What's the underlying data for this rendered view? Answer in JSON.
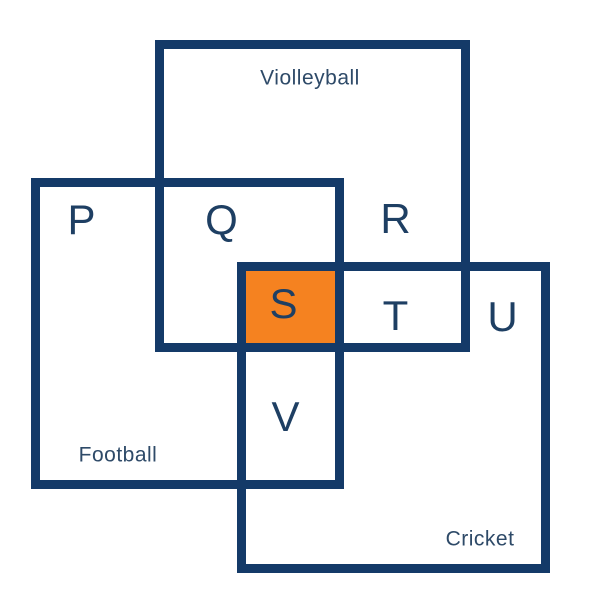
{
  "diagram": {
    "type": "overlapping-rectangles-venn",
    "sets": [
      {
        "label": "Violleyball"
      },
      {
        "label": "Football"
      },
      {
        "label": "Cricket"
      }
    ],
    "regions": [
      {
        "label": "P",
        "meaning": "Football only",
        "highlighted": false
      },
      {
        "label": "Q",
        "meaning": "Violleyball and Football",
        "highlighted": false
      },
      {
        "label": "R",
        "meaning": "Violleyball only",
        "highlighted": false
      },
      {
        "label": "S",
        "meaning": "Violleyball, Football and Cricket",
        "highlighted": true
      },
      {
        "label": "T",
        "meaning": "Violleyball and Cricket",
        "highlighted": false
      },
      {
        "label": "U",
        "meaning": "Cricket only",
        "highlighted": false
      },
      {
        "label": "V",
        "meaning": "Football and Cricket",
        "highlighted": false
      }
    ],
    "colors": {
      "border": "#143A68",
      "region_text": "#1E3F63",
      "set_label_text": "#2E4A68",
      "highlight": "#F58220",
      "background": "#FFFFFF"
    }
  }
}
